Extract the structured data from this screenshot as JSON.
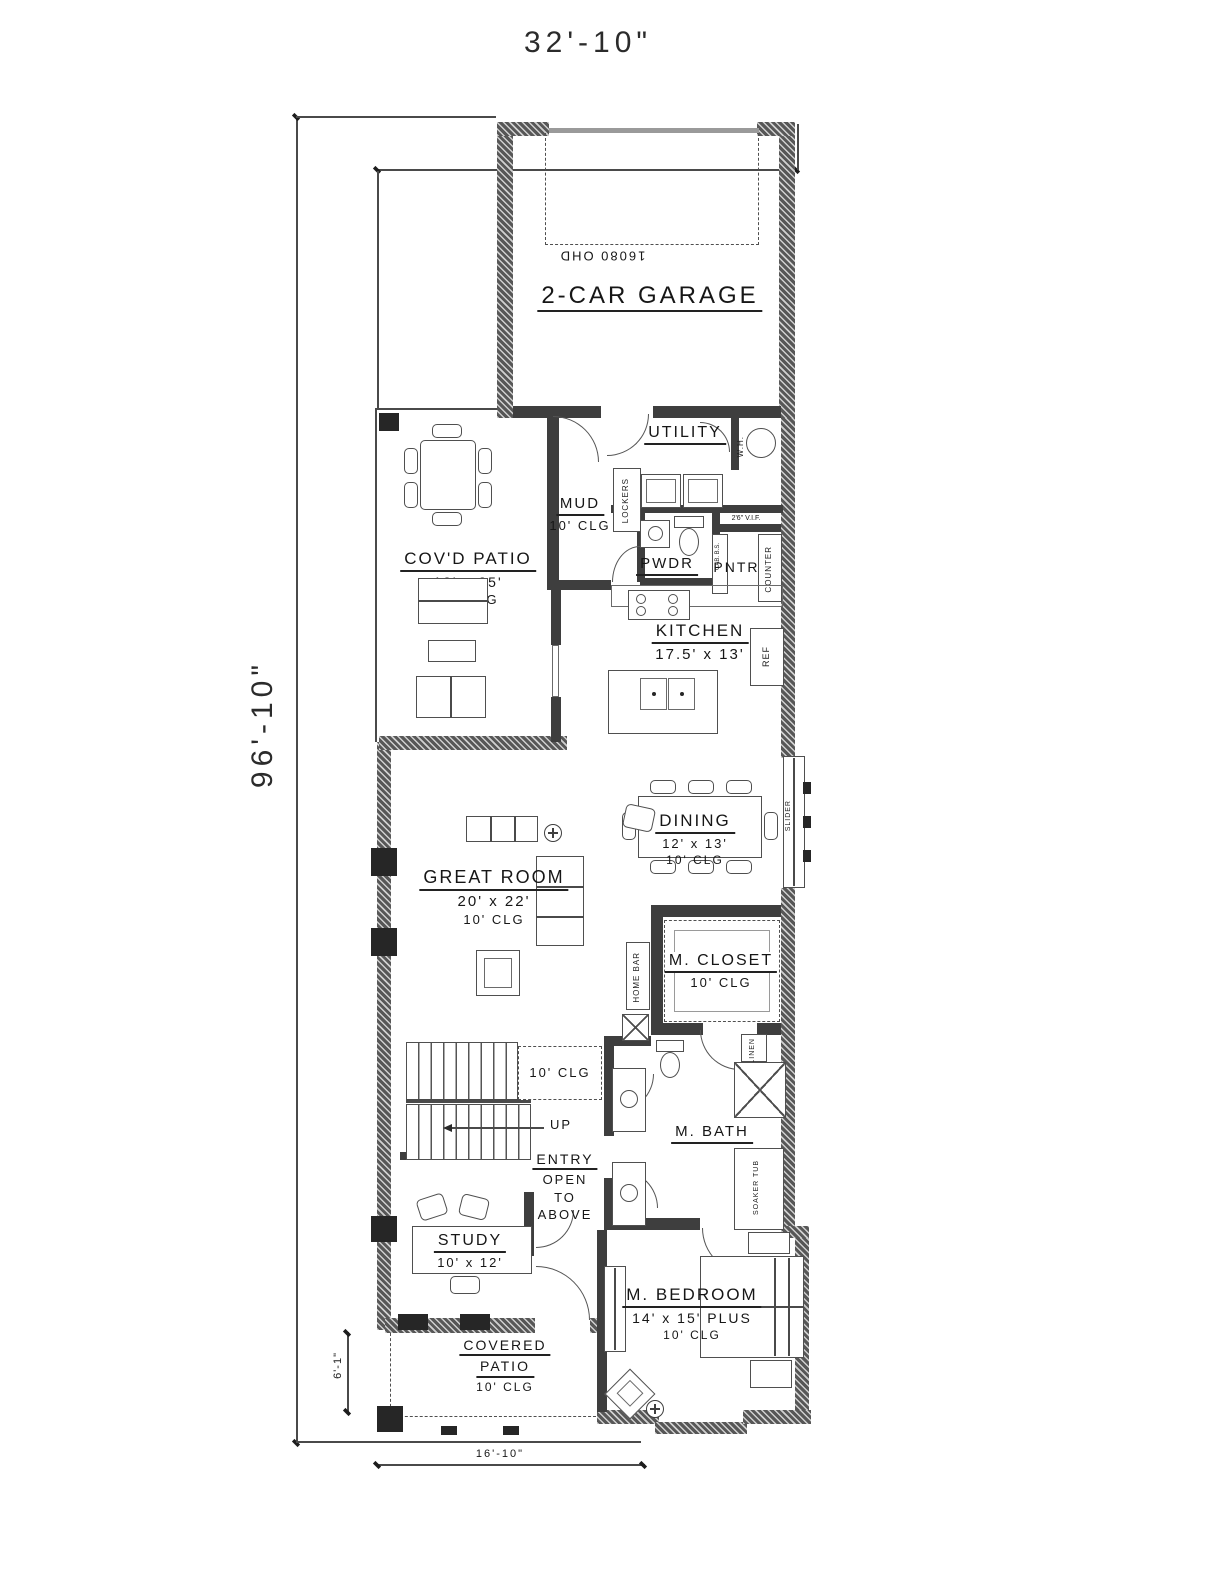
{
  "dimensions": {
    "overall_width": "32'-10\"",
    "overall_depth": "96'-10\"",
    "porch_depth": "6'-1\"",
    "porch_width": "16'-10\""
  },
  "rooms": {
    "garage": {
      "label": "2-CAR GARAGE",
      "door_note": "16080 OHD"
    },
    "utility": {
      "label": "UTILITY",
      "water_heater": "W.H."
    },
    "mud": {
      "label": "MUD",
      "clg": "10' CLG",
      "lockers": "LOCKERS"
    },
    "covd_patio": {
      "label": "COV'D PATIO",
      "size": "13' x 25'",
      "clg": "10' CLG"
    },
    "pwdr": {
      "label": "PWDR"
    },
    "pntry": {
      "label": "PNTRY",
      "note": "2'6\" V.I.F.",
      "counter": "COUNTER",
      "cabinet": "CAB. B.S."
    },
    "kitchen": {
      "label": "KITCHEN",
      "size": "17.5' x 13'",
      "ref": "REF"
    },
    "dining": {
      "label": "DINING",
      "size": "12' x 13'",
      "clg": "10' CLG",
      "slider": "SLIDER"
    },
    "great_room": {
      "label": "GREAT ROOM",
      "size": "20' x 22'",
      "clg": "10' CLG",
      "home_bar": "HOME BAR"
    },
    "m_closet": {
      "label": "M. CLOSET",
      "clg": "10' CLG",
      "linen": "LINEN"
    },
    "stair_hall": {
      "clg": "10' CLG",
      "up": "UP"
    },
    "m_bath": {
      "label": "M. BATH",
      "soaker_tub": "SOAKER TUB"
    },
    "entry": {
      "label": "ENTRY",
      "line2": "OPEN",
      "line3": "TO",
      "line4": "ABOVE"
    },
    "study": {
      "label": "STUDY",
      "size": "10' x 12'"
    },
    "covered_patio": {
      "label1": "COVERED",
      "label2": "PATIO",
      "clg": "10' CLG"
    },
    "m_bedroom": {
      "label": "M. BEDROOM",
      "size": "14' x 15' PLUS",
      "clg": "10' CLG"
    }
  }
}
